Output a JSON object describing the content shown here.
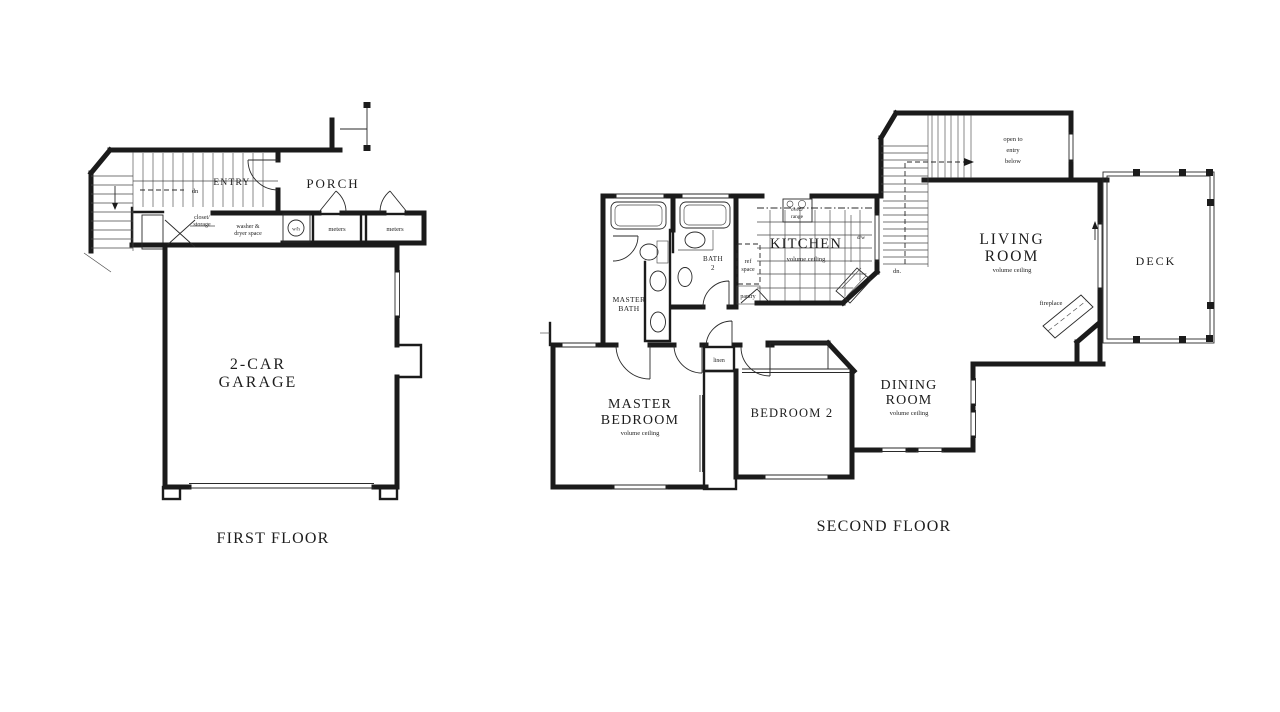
{
  "colors": {
    "ink": "#1b1b1b",
    "paper": "#ffffff"
  },
  "first_floor": {
    "title": "FIRST FLOOR",
    "labels": {
      "entry": "ENTRY",
      "dn": "dn",
      "closet_storage": [
        "closet/",
        "storage"
      ],
      "washer_dryer": [
        "washer &",
        "dryer space"
      ],
      "water_heater": "w/h",
      "meters_left": "meters",
      "meters_right": "meters",
      "porch": "PORCH",
      "garage": [
        "2-CAR",
        "GARAGE"
      ]
    }
  },
  "second_floor": {
    "title": "SECOND FLOOR",
    "labels": {
      "master_bath": [
        "MASTER",
        "BATH"
      ],
      "bath_2": [
        "BATH",
        "2"
      ],
      "ref_space": [
        "ref",
        "space"
      ],
      "pantry": "pantry",
      "linen": "linen",
      "oven_range": [
        "oven/",
        "range"
      ],
      "dishwasher": "d/w",
      "kitchen": "KITCHEN",
      "kitchen_ceiling": "volume ceiling",
      "down": "dn.",
      "open_to_entry": [
        "open to",
        "entry",
        "below"
      ],
      "living_room": [
        "LIVING",
        "ROOM"
      ],
      "living_ceiling": "volume ceiling",
      "deck": "DECK",
      "fireplace": "fireplace",
      "dining_room": [
        "DINING",
        "ROOM"
      ],
      "dining_ceiling": "volume ceiling",
      "master_bedroom": [
        "MASTER",
        "BEDROOM"
      ],
      "master_ceiling": "volume ceiling",
      "bedroom_2": "BEDROOM 2"
    }
  }
}
